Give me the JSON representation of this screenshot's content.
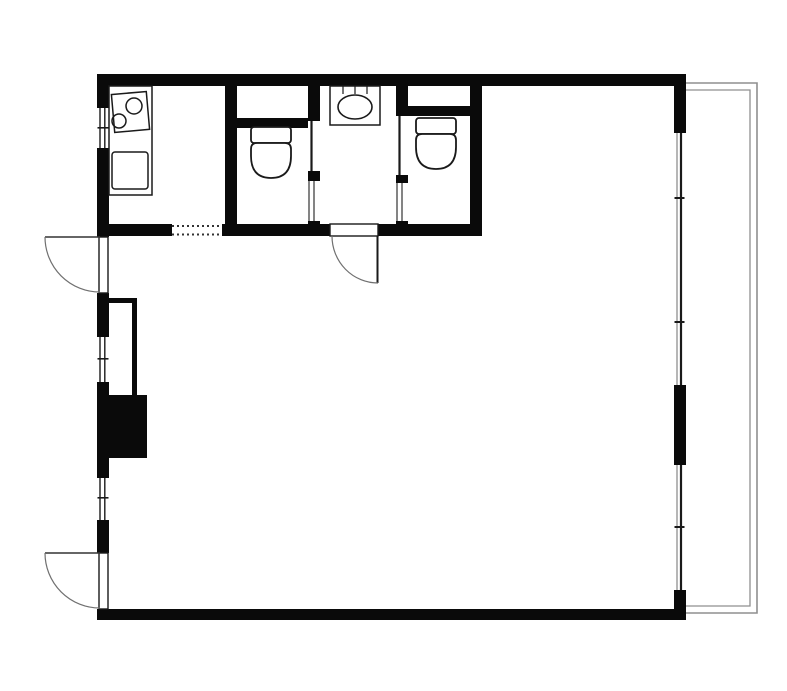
{
  "canvas": {
    "width": 787,
    "height": 691,
    "background": "#ffffff"
  },
  "colors": {
    "wall": "#0a0a0a",
    "line": "#1a1a1a",
    "mid": "#333333",
    "arc": "#707070",
    "gray": "#8f8f8f",
    "white": "#ffffff"
  },
  "plan_semantics": {
    "drawing_type": "apartment-floor-plan",
    "rooms": [
      "kitchen",
      "toilet-a",
      "washroom",
      "toilet-b",
      "main-room",
      "storage-niche",
      "pipe-shaft",
      "balcony"
    ],
    "fixture_icons": [
      "two-burner-stove-icon",
      "kitchen-sink-icon",
      "toilet-icon",
      "toilet-icon",
      "washbasin-icon"
    ],
    "swing_door_count": 3,
    "sliding_door_count": 2,
    "window_count": 5,
    "dotted_opening_count": 1
  },
  "shapes": [
    {
      "t": "rect",
      "n": "wall-top",
      "x": 97,
      "y": 74,
      "w": 589,
      "h": 12,
      "f": "wall"
    },
    {
      "t": "rect",
      "n": "wall-left-a",
      "x": 97,
      "y": 74,
      "w": 12,
      "h": 34,
      "f": "wall"
    },
    {
      "t": "rect",
      "n": "wall-left-b",
      "x": 97,
      "y": 148,
      "w": 12,
      "h": 89,
      "f": "wall"
    },
    {
      "t": "rect",
      "n": "wall-left-c",
      "x": 97,
      "y": 293,
      "w": 12,
      "h": 44,
      "f": "wall"
    },
    {
      "t": "rect",
      "n": "wall-left-d",
      "x": 97,
      "y": 382,
      "w": 12,
      "h": 96,
      "f": "wall"
    },
    {
      "t": "rect",
      "n": "wall-left-e",
      "x": 97,
      "y": 520,
      "w": 12,
      "h": 33,
      "f": "wall"
    },
    {
      "t": "rect",
      "n": "wall-bottom",
      "x": 97,
      "y": 609,
      "w": 589,
      "h": 11,
      "f": "wall"
    },
    {
      "t": "rect",
      "n": "wall-right-a",
      "x": 674,
      "y": 74,
      "w": 12,
      "h": 59,
      "f": "wall"
    },
    {
      "t": "rect",
      "n": "wall-right-b",
      "x": 674,
      "y": 385,
      "w": 12,
      "h": 80,
      "f": "wall"
    },
    {
      "t": "rect",
      "n": "wall-right-c",
      "x": 674,
      "y": 590,
      "w": 12,
      "h": 30,
      "f": "wall"
    },
    {
      "t": "rect",
      "n": "wall-kitchen-divider",
      "x": 225,
      "y": 74,
      "w": 12,
      "h": 162,
      "f": "wall"
    },
    {
      "t": "rect",
      "n": "wall-band-bottom-a",
      "x": 97,
      "y": 224,
      "w": 75,
      "h": 12,
      "f": "wall"
    },
    {
      "t": "rect",
      "n": "wall-band-bottom-b",
      "x": 222,
      "y": 224,
      "w": 108,
      "h": 12,
      "f": "wall"
    },
    {
      "t": "rect",
      "n": "wall-band-bottom-c",
      "x": 378,
      "y": 224,
      "w": 104,
      "h": 12,
      "f": "wall"
    },
    {
      "t": "rect",
      "n": "wall-toilet-a-right-upper",
      "x": 308,
      "y": 74,
      "w": 12,
      "h": 47,
      "f": "wall"
    },
    {
      "t": "rect",
      "n": "wall-toilet-a-right-stub",
      "x": 308,
      "y": 171,
      "w": 12,
      "h": 10,
      "f": "wall"
    },
    {
      "t": "rect",
      "n": "wall-toilet-a-right-lower",
      "x": 308,
      "y": 221,
      "w": 12,
      "h": 15,
      "f": "wall"
    },
    {
      "t": "rect",
      "n": "wall-toilet-b-left-upper",
      "x": 396,
      "y": 74,
      "w": 12,
      "h": 42,
      "f": "wall"
    },
    {
      "t": "rect",
      "n": "wall-toilet-b-left-stub",
      "x": 396,
      "y": 175,
      "w": 12,
      "h": 8,
      "f": "wall"
    },
    {
      "t": "rect",
      "n": "wall-toilet-b-left-lower",
      "x": 396,
      "y": 221,
      "w": 12,
      "h": 15,
      "f": "wall"
    },
    {
      "t": "rect",
      "n": "wall-toilet-b-right",
      "x": 470,
      "y": 74,
      "w": 12,
      "h": 162,
      "f": "wall"
    },
    {
      "t": "rect",
      "n": "wall-toilet-a-top-inner",
      "x": 237,
      "y": 118,
      "w": 71,
      "h": 10,
      "f": "wall"
    },
    {
      "t": "rect",
      "n": "wall-toilet-b-top-inner",
      "x": 408,
      "y": 106,
      "w": 62,
      "h": 10,
      "f": "wall"
    },
    {
      "t": "rect",
      "n": "niche-wall-top",
      "x": 103,
      "y": 298,
      "w": 34,
      "h": 5,
      "f": "wall"
    },
    {
      "t": "rect",
      "n": "niche-wall-right",
      "x": 132,
      "y": 298,
      "w": 5,
      "h": 97,
      "f": "wall"
    },
    {
      "t": "rect",
      "n": "pipe-shaft-box",
      "x": 102,
      "y": 395,
      "w": 45,
      "h": 63,
      "f": "wall"
    },
    {
      "t": "rect",
      "n": "window-left-1-glass",
      "x": 97,
      "y": 108,
      "w": 12,
      "h": 40,
      "f": "white"
    },
    {
      "t": "line",
      "n": "window-left-1-pane-a",
      "x": 100,
      "y": 108,
      "x2": 100,
      "y2": 148,
      "s": "line",
      "sw": 1.4
    },
    {
      "t": "line",
      "n": "window-left-1-pane-b",
      "x": 104.8,
      "y": 108,
      "x2": 104.8,
      "y2": 148,
      "s": "line",
      "sw": 1.4
    },
    {
      "t": "rect",
      "n": "window-left-1-tick",
      "x": 97.5,
      "y": 127,
      "w": 11,
      "h": 1.6,
      "f": "line"
    },
    {
      "t": "rect",
      "n": "window-left-2-glass",
      "x": 97,
      "y": 337,
      "w": 12,
      "h": 45,
      "f": "white"
    },
    {
      "t": "line",
      "n": "window-left-2-pane-a",
      "x": 100,
      "y": 337,
      "x2": 100,
      "y2": 382,
      "s": "line",
      "sw": 1.4
    },
    {
      "t": "line",
      "n": "window-left-2-pane-b",
      "x": 104.8,
      "y": 337,
      "x2": 104.8,
      "y2": 382,
      "s": "line",
      "sw": 1.4
    },
    {
      "t": "rect",
      "n": "window-left-2-tick",
      "x": 97.5,
      "y": 358,
      "w": 11,
      "h": 1.6,
      "f": "line"
    },
    {
      "t": "rect",
      "n": "window-left-3-glass",
      "x": 97,
      "y": 478,
      "w": 12,
      "h": 42,
      "f": "white"
    },
    {
      "t": "line",
      "n": "window-left-3-pane-a",
      "x": 100,
      "y": 478,
      "x2": 100,
      "y2": 520,
      "s": "line",
      "sw": 1.4
    },
    {
      "t": "line",
      "n": "window-left-3-pane-b",
      "x": 104.8,
      "y": 478,
      "x2": 104.8,
      "y2": 520,
      "s": "line",
      "sw": 1.4
    },
    {
      "t": "rect",
      "n": "window-left-3-tick",
      "x": 97.5,
      "y": 497,
      "w": 11,
      "h": 1.6,
      "f": "line"
    },
    {
      "t": "rect",
      "n": "window-right-1-glass",
      "x": 674,
      "y": 133,
      "w": 12,
      "h": 252,
      "f": "white"
    },
    {
      "t": "rect",
      "n": "window-right-2-glass",
      "x": 674,
      "y": 465,
      "w": 12,
      "h": 125,
      "f": "white"
    },
    {
      "t": "line",
      "n": "window-right-1-pane-outer",
      "x": 677,
      "y": 133,
      "x2": 677,
      "y2": 385,
      "s": "gray",
      "sw": 1.3
    },
    {
      "t": "line",
      "n": "window-right-1-pane-inner",
      "x": 681,
      "y": 133,
      "x2": 681,
      "y2": 385,
      "s": "line",
      "sw": 2.2
    },
    {
      "t": "line",
      "n": "window-right-2-pane-outer",
      "x": 677,
      "y": 465,
      "x2": 677,
      "y2": 590,
      "s": "gray",
      "sw": 1.3
    },
    {
      "t": "line",
      "n": "window-right-2-pane-inner",
      "x": 681,
      "y": 465,
      "x2": 681,
      "y2": 590,
      "s": "line",
      "sw": 2.2
    },
    {
      "t": "rect",
      "n": "window-right-junction-1",
      "x": 674.5,
      "y": 197,
      "w": 10,
      "h": 2,
      "f": "line"
    },
    {
      "t": "rect",
      "n": "window-right-junction-2",
      "x": 674.5,
      "y": 321,
      "w": 10,
      "h": 2,
      "f": "line"
    },
    {
      "t": "rect",
      "n": "window-right-junction-3",
      "x": 674.5,
      "y": 526,
      "w": 10,
      "h": 2,
      "f": "line"
    },
    {
      "t": "rect",
      "n": "entry-door-leaf",
      "x": 99,
      "y": 237,
      "w": 9,
      "h": 56,
      "f": "white",
      "s": "line",
      "sw": 1.4
    },
    {
      "t": "line",
      "n": "entry-door-open-leaf",
      "x": 45,
      "y": 237,
      "x2": 100,
      "y2": 237,
      "s": "mid",
      "sw": 1.4
    },
    {
      "t": "path",
      "n": "entry-door-swing-arc",
      "d": "M45,237 A55,55 0 0 0 100,292",
      "s": "arc",
      "sw": 1.2
    },
    {
      "t": "rect",
      "n": "terrace-door-leaf",
      "x": 99,
      "y": 553,
      "w": 9,
      "h": 56,
      "f": "white",
      "s": "line",
      "sw": 1.4
    },
    {
      "t": "line",
      "n": "terrace-door-open-leaf",
      "x": 45,
      "y": 553,
      "x2": 100,
      "y2": 553,
      "s": "mid",
      "sw": 1.4
    },
    {
      "t": "path",
      "n": "terrace-door-swing-arc",
      "d": "M45,553 A55,55 0 0 0 100,608",
      "s": "arc",
      "sw": 1.2
    },
    {
      "t": "rect",
      "n": "washroom-door-frame",
      "x": 330,
      "y": 224,
      "w": 48,
      "h": 12,
      "f": "white",
      "s": "line",
      "sw": 1.4
    },
    {
      "t": "line",
      "n": "washroom-door-open-leaf",
      "x": 377.5,
      "y": 236,
      "x2": 377.5,
      "y2": 283,
      "s": "line",
      "sw": 2
    },
    {
      "t": "path",
      "n": "washroom-door-swing-arc",
      "d": "M332,236 A46,47 0 0 0 378,283",
      "s": "arc",
      "sw": 1.2
    },
    {
      "t": "line",
      "n": "toilet-a-door-leaf",
      "x": 311.5,
      "y": 121,
      "x2": 311.5,
      "y2": 171,
      "s": "line",
      "sw": 2.2
    },
    {
      "t": "line",
      "n": "toilet-b-door-leaf",
      "x": 399.5,
      "y": 116,
      "x2": 399.5,
      "y2": 175,
      "s": "line",
      "sw": 2.2
    },
    {
      "t": "line",
      "n": "toilet-a-pocket-line-a",
      "x": 309,
      "y": 181,
      "x2": 309,
      "y2": 221,
      "s": "mid",
      "sw": 1.2
    },
    {
      "t": "line",
      "n": "toilet-a-pocket-line-b",
      "x": 314,
      "y": 181,
      "x2": 314,
      "y2": 221,
      "s": "mid",
      "sw": 1.2
    },
    {
      "t": "line",
      "n": "toilet-b-pocket-line-a",
      "x": 397,
      "y": 183,
      "x2": 397,
      "y2": 221,
      "s": "mid",
      "sw": 1.2
    },
    {
      "t": "line",
      "n": "toilet-b-pocket-line-b",
      "x": 402,
      "y": 183,
      "x2": 402,
      "y2": 221,
      "s": "mid",
      "sw": 1.2
    },
    {
      "t": "line",
      "n": "kitchen-opening-dotted-top",
      "x": 172,
      "y": 226,
      "x2": 222,
      "y2": 226,
      "s": "mid",
      "sw": 2,
      "da": "2 3"
    },
    {
      "t": "line",
      "n": "kitchen-opening-dotted-bottom",
      "x": 172,
      "y": 234.5,
      "x2": 222,
      "y2": 234.5,
      "s": "mid",
      "sw": 2,
      "da": "2 3"
    },
    {
      "t": "rect",
      "n": "kitchen-counter",
      "x": 109,
      "y": 86,
      "w": 43,
      "h": 109,
      "f": "white",
      "s": "line",
      "sw": 1.5
    },
    {
      "t": "rect",
      "n": "stove-top",
      "x": 113,
      "y": 93,
      "w": 35,
      "h": 38,
      "s": "line",
      "sw": 1.5,
      "tr": "rotate(-5 130 112)"
    },
    {
      "t": "circle",
      "n": "stove-burner-large",
      "x": 134,
      "y": 106,
      "r": 8,
      "s": "line",
      "sw": 1.5
    },
    {
      "t": "circle",
      "n": "stove-burner-small",
      "x": 119,
      "y": 121,
      "r": 7,
      "s": "line",
      "sw": 1.5
    },
    {
      "t": "rect",
      "n": "kitchen-sink",
      "x": 112,
      "y": 152,
      "w": 36,
      "h": 37,
      "rx": 3,
      "s": "line",
      "sw": 1.5
    },
    {
      "t": "rect",
      "n": "washbasin-counter",
      "x": 330,
      "y": 86,
      "w": 50,
      "h": 39,
      "f": "white",
      "s": "line",
      "sw": 1.5
    },
    {
      "t": "line",
      "n": "washbasin-divider-1",
      "x": 343,
      "y": 86,
      "x2": 343,
      "y2": 94,
      "s": "line",
      "sw": 1.2
    },
    {
      "t": "line",
      "n": "washbasin-divider-2",
      "x": 355,
      "y": 86,
      "x2": 355,
      "y2": 94,
      "s": "line",
      "sw": 1.2
    },
    {
      "t": "line",
      "n": "washbasin-divider-3",
      "x": 367,
      "y": 86,
      "x2": 367,
      "y2": 94,
      "s": "line",
      "sw": 1.2
    },
    {
      "t": "ellipse",
      "n": "washbasin-bowl",
      "x": 355,
      "y": 107,
      "rx": 17,
      "ry": 12,
      "s": "line",
      "sw": 1.6
    },
    {
      "t": "rect",
      "n": "toilet-a-tank",
      "x": 251,
      "y": 127,
      "w": 40,
      "h": 16,
      "rx": 3,
      "f": "white",
      "s": "line",
      "sw": 1.8
    },
    {
      "t": "path",
      "n": "toilet-a-bowl",
      "d": "M257,143 L285,143 Q291,143 291,149 L291,156 Q291,178 271,178 Q251,178 251,156 L251,149 Q251,143 257,143 Z",
      "f": "white",
      "s": "line",
      "sw": 1.8
    },
    {
      "t": "rect",
      "n": "toilet-b-tank",
      "x": 416,
      "y": 118,
      "w": 40,
      "h": 16,
      "rx": 3,
      "f": "white",
      "s": "line",
      "sw": 1.8
    },
    {
      "t": "path",
      "n": "toilet-b-bowl",
      "d": "M422,134 L450,134 Q456,134 456,140 L456,147 Q456,169 436,169 Q416,169 416,147 L416,140 Q416,134 422,134 Z",
      "f": "white",
      "s": "line",
      "sw": 1.8
    },
    {
      "t": "path",
      "n": "balcony-outer-rail",
      "d": "M686,83 L757,83 L757,613 L686,613",
      "s": "gray",
      "sw": 1.6
    },
    {
      "t": "path",
      "n": "balcony-inner-rail",
      "d": "M686,90 L750,90 L750,606 L686,606",
      "s": "gray",
      "sw": 1.3
    }
  ]
}
